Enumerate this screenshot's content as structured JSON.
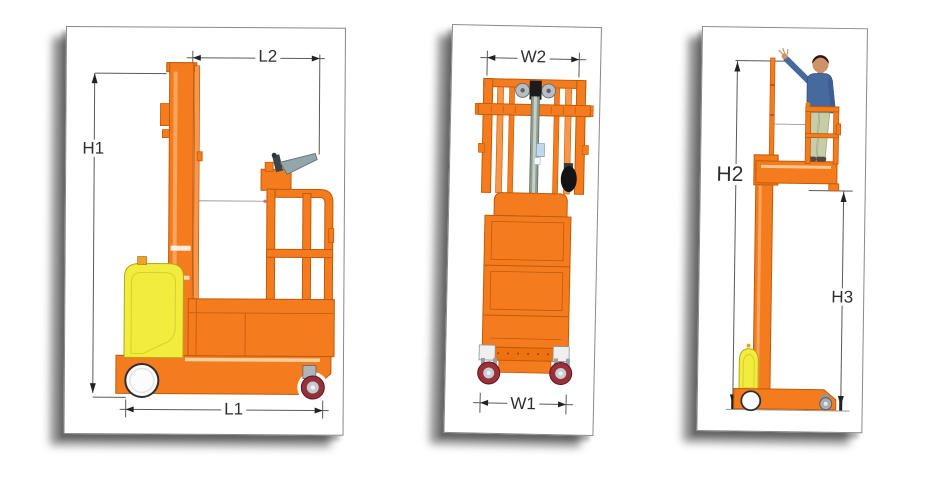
{
  "views": {
    "side": {
      "dims": {
        "top": "L2",
        "left": "H1",
        "bottom": "L1"
      }
    },
    "front": {
      "dims": {
        "top": "W2",
        "bottom": "W1"
      }
    },
    "reach": {
      "dims": {
        "left": "H2",
        "right": "H3"
      }
    }
  },
  "colors": {
    "machine_orange": "#F57C1E",
    "machine_orange_dark": "#C05A08",
    "battery_yellow": "#F1EC3E",
    "caster_red": "#93323C",
    "lift_cylinder_gray": "#8D9D90",
    "person_shirt_blue": "#46699E",
    "person_pants_khaki": "#C7CDA6",
    "dimension_line": "#5a5a5a",
    "panel_shadow": "#1a1a1a"
  }
}
